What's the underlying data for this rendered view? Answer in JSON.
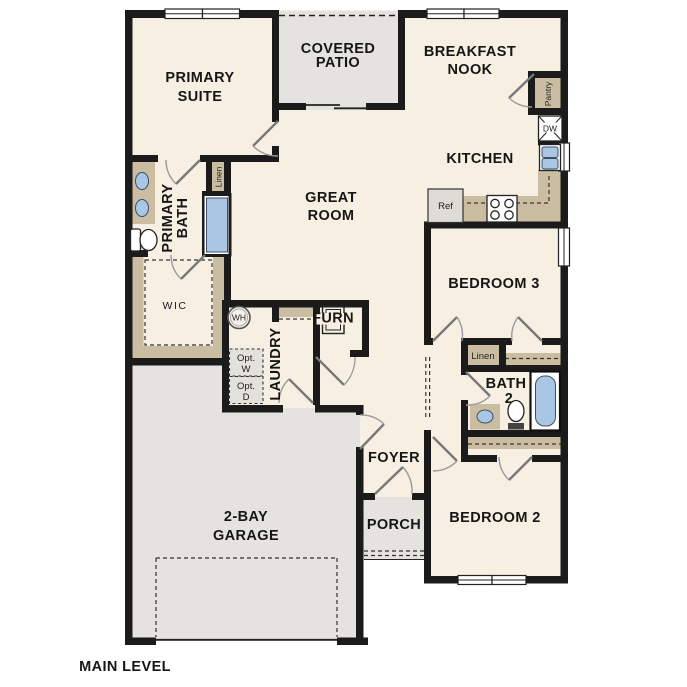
{
  "title": "MAIN LEVEL",
  "colors": {
    "floor": "#f6efe2",
    "gray": "#e4e3df",
    "tan": "#cbbda2",
    "blue": "#a9c6e4",
    "wall": "#1b1b1b",
    "ink": "#161616"
  },
  "rooms": {
    "primary_suite": {
      "line1": "PRIMARY",
      "line2": "SUITE"
    },
    "covered_patio": {
      "line1": "COVERED",
      "line2": "PATIO"
    },
    "breakfast_nook": {
      "line1": "BREAKFAST",
      "line2": "NOOK"
    },
    "great_room": {
      "line1": "GREAT",
      "line2": "ROOM"
    },
    "kitchen": {
      "label": "KITCHEN"
    },
    "primary_bath": {
      "line1": "PRIMARY",
      "line2": "BATH"
    },
    "wic": {
      "label": "WIC"
    },
    "laundry": {
      "label": "LAUNDRY"
    },
    "bedroom3": {
      "label": "BEDROOM 3"
    },
    "bath2": {
      "line1": "BATH",
      "line2": "2"
    },
    "bedroom2": {
      "label": "BEDROOM 2"
    },
    "foyer": {
      "label": "FOYER"
    },
    "porch": {
      "label": "PORCH"
    },
    "garage": {
      "line1": "2-BAY",
      "line2": "GARAGE"
    }
  },
  "closets": {
    "linen_bath": "Linen",
    "linen_hall": "Linen",
    "pantry": "Pantry"
  },
  "appliances": {
    "dishwasher": "DW",
    "refrigerator": "Ref",
    "water_heater": "WH",
    "furnace": "FURN",
    "opt_washer": {
      "line1": "Opt.",
      "line2": "W"
    },
    "opt_dryer": {
      "line1": "Opt.",
      "line2": "D"
    }
  }
}
